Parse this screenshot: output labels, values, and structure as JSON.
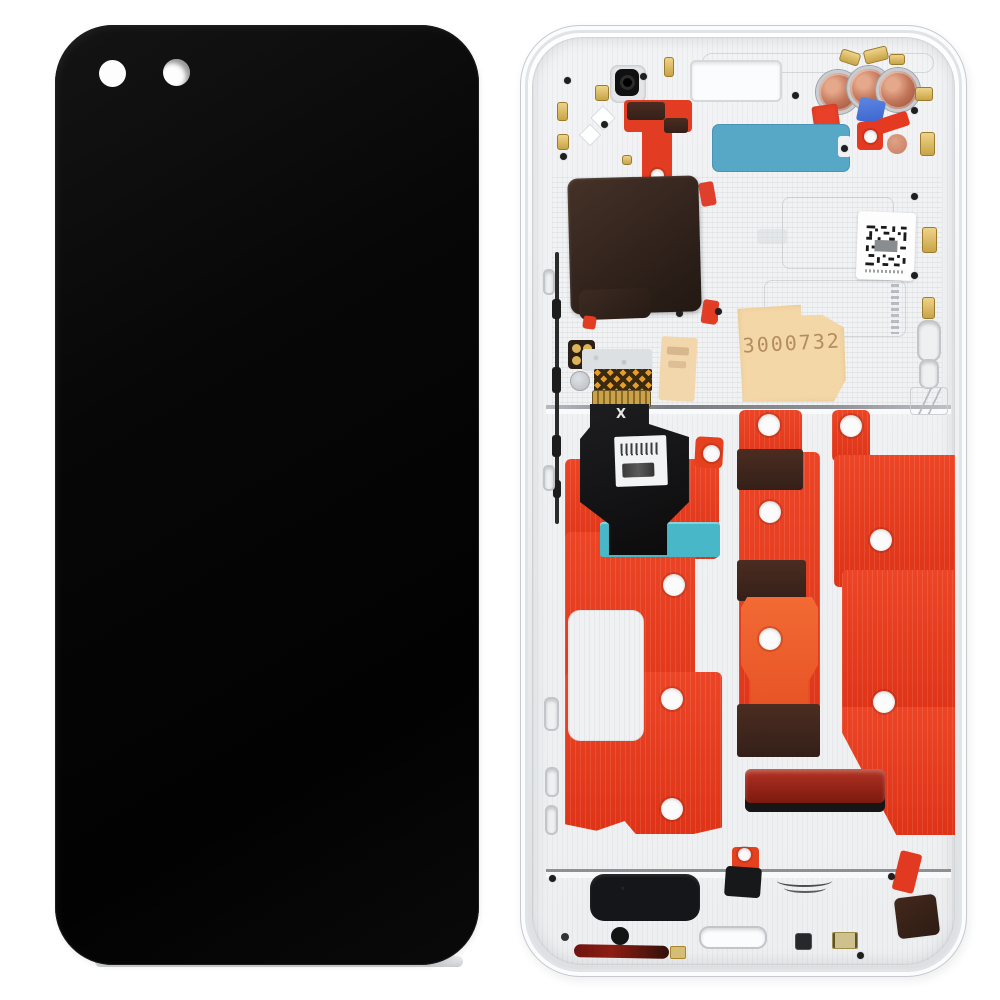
{
  "scene": {
    "title": "Phone LCD screen and digitizer full assembly with frame - front and back view",
    "background_color": "#ffffff"
  },
  "front_panel": {
    "name": "front screen assembly",
    "screen_color": "#060606",
    "camera_hole_count": "2"
  },
  "back_frame": {
    "name": "mid-frame back view",
    "markings": {
      "serial": "3000732",
      "flex_mark": "X"
    },
    "colors": {
      "frame_silver": "#eef0f2",
      "adhesive_red": "#e6391f",
      "adhesive_orange": "#ef6232",
      "adhesive_band_brown": "#3f2820",
      "graphite_pad": "#342722",
      "teal_sticker": "#57a7c6",
      "cyan_strip": "#48b8c8",
      "tan_sticker": "#f4d7a6",
      "copper_coil": "#c3775b",
      "blue_sticker": "#3e6bd6",
      "maroon_gloss": "#8c2014",
      "gold_contact": "#d9b24a",
      "flex_black": "#141415"
    }
  }
}
